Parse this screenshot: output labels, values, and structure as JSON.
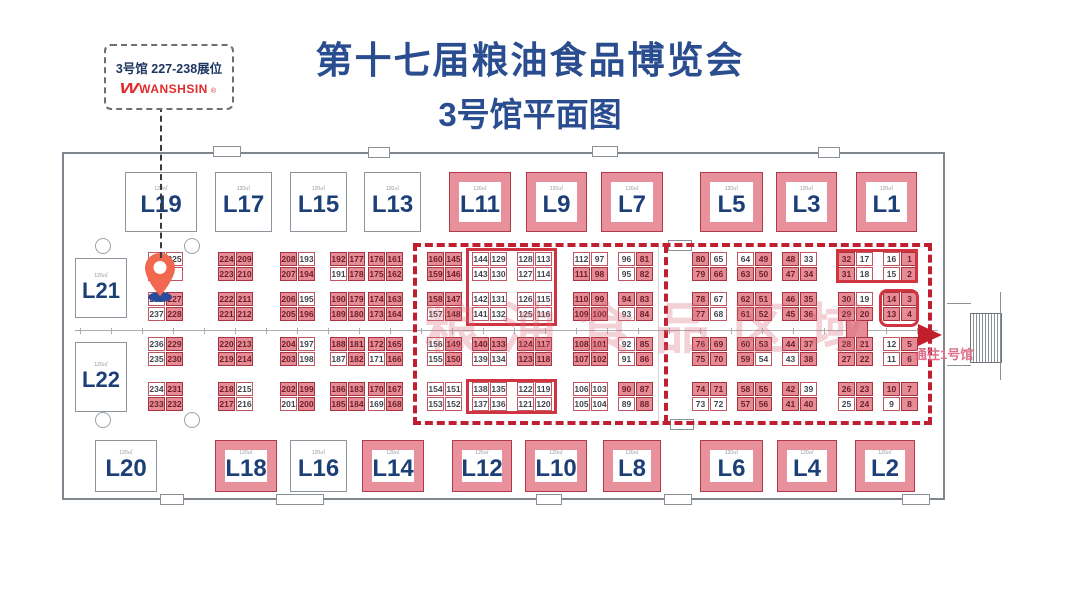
{
  "title": {
    "line1": "第十七届粮油食品博览会",
    "line2": "3号馆平面图"
  },
  "callout": {
    "booths_text": "3号馆 227-238展位",
    "logo_glyph": "W",
    "brand": "WANSHSIN",
    "reg_mark": "®"
  },
  "watermark": "粮油食品区域",
  "exit": {
    "label": "通往1号馆"
  },
  "area_label": "120㎡",
  "colors": {
    "title_blue": "#2a4d8f",
    "brand_red": "#e02c2c",
    "navy_label": "#1d3f77",
    "booth_pink": "#e8919c",
    "cell_pink": "#e58c97",
    "cell_border_red": "#a8323e",
    "dashed_red": "#bf1f2e",
    "pin_red": "#f2674f",
    "pin_blue": "#2a4b9b",
    "wall_gray": "#80868d",
    "watermark_pink": "#d96b7a"
  },
  "large_booths": {
    "top_y": 172,
    "top_h": 60,
    "bottom_y": 440,
    "bottom_h": 52,
    "top": [
      {
        "label": "L19",
        "x": 125,
        "w": 72,
        "pink": 0
      },
      {
        "label": "L17",
        "x": 215,
        "w": 57,
        "pink": 0
      },
      {
        "label": "L15",
        "x": 290,
        "w": 57,
        "pink": 0
      },
      {
        "label": "L13",
        "x": 364,
        "w": 57,
        "pink": 0
      },
      {
        "label": "L11",
        "x": 449,
        "w": 62,
        "pink": 1
      },
      {
        "label": "L9",
        "x": 526,
        "w": 61,
        "pink": 1
      },
      {
        "label": "L7",
        "x": 601,
        "w": 62,
        "pink": 1
      },
      {
        "label": "L5",
        "x": 700,
        "w": 63,
        "pink": 1
      },
      {
        "label": "L3",
        "x": 776,
        "w": 61,
        "pink": 1
      },
      {
        "label": "L1",
        "x": 856,
        "w": 61,
        "pink": 1
      }
    ],
    "bottom": [
      {
        "label": "L20",
        "x": 95,
        "w": 62,
        "pink": 0
      },
      {
        "label": "L18",
        "x": 215,
        "w": 62,
        "pink": 1
      },
      {
        "label": "L16",
        "x": 290,
        "w": 57,
        "pink": 0
      },
      {
        "label": "L14",
        "x": 362,
        "w": 62,
        "pink": 1
      },
      {
        "label": "L12",
        "x": 452,
        "w": 60,
        "pink": 1
      },
      {
        "label": "L10",
        "x": 525,
        "w": 62,
        "pink": 1
      },
      {
        "label": "L8",
        "x": 603,
        "w": 58,
        "pink": 1
      },
      {
        "label": "L6",
        "x": 700,
        "w": 63,
        "pink": 1
      },
      {
        "label": "L4",
        "x": 777,
        "w": 60,
        "pink": 1
      },
      {
        "label": "L2",
        "x": 855,
        "w": 60,
        "pink": 1
      }
    ],
    "left": [
      {
        "label": "L21",
        "x": 75,
        "y": 258,
        "w": 52,
        "h": 60,
        "pink": 0
      },
      {
        "label": "L22",
        "x": 75,
        "y": 342,
        "w": 52,
        "h": 70,
        "pink": 0
      }
    ]
  },
  "row_y": [
    252,
    267,
    292,
    307,
    337,
    352,
    382,
    397
  ],
  "booth_pairs": [
    {
      "x": 148,
      "rows": [
        [
          "240",
          0,
          "225",
          0
        ],
        [
          "",
          0,
          "",
          0
        ],
        [
          "238",
          0,
          "227",
          1
        ],
        [
          "237",
          0,
          "228",
          1
        ],
        [
          "236",
          0,
          "229",
          1
        ],
        [
          "235",
          0,
          "230",
          1
        ],
        [
          "234",
          0,
          "231",
          1
        ],
        [
          "233",
          1,
          "232",
          1
        ]
      ]
    },
    {
      "x": 218,
      "rows": [
        [
          "224",
          1,
          "209",
          1
        ],
        [
          "223",
          1,
          "210",
          1
        ],
        [
          "222",
          1,
          "211",
          1
        ],
        [
          "221",
          1,
          "212",
          1
        ],
        [
          "220",
          1,
          "213",
          1
        ],
        [
          "219",
          1,
          "214",
          1
        ],
        [
          "218",
          1,
          "215",
          0
        ],
        [
          "217",
          1,
          "216",
          0
        ]
      ]
    },
    {
      "x": 280,
      "rows": [
        [
          "208",
          1,
          "193",
          0
        ],
        [
          "207",
          1,
          "194",
          1
        ],
        [
          "206",
          1,
          "195",
          0
        ],
        [
          "205",
          1,
          "196",
          1
        ],
        [
          "204",
          1,
          "197",
          0
        ],
        [
          "203",
          1,
          "198",
          0
        ],
        [
          "202",
          1,
          "199",
          1
        ],
        [
          "201",
          0,
          "200",
          1
        ]
      ]
    },
    {
      "x": 330,
      "rows": [
        [
          "192",
          1,
          "177",
          1
        ],
        [
          "191",
          0,
          "178",
          1
        ],
        [
          "190",
          1,
          "179",
          1
        ],
        [
          "189",
          1,
          "180",
          1
        ],
        [
          "188",
          1,
          "181",
          1
        ],
        [
          "187",
          0,
          "182",
          1
        ],
        [
          "186",
          1,
          "183",
          1
        ],
        [
          "185",
          1,
          "184",
          1
        ]
      ]
    },
    {
      "x": 368,
      "rows": [
        [
          "176",
          1,
          "161",
          1
        ],
        [
          "175",
          1,
          "162",
          1
        ],
        [
          "174",
          1,
          "163",
          1
        ],
        [
          "173",
          1,
          "164",
          1
        ],
        [
          "172",
          1,
          "165",
          1
        ],
        [
          "171",
          0,
          "166",
          1
        ],
        [
          "170",
          1,
          "167",
          1
        ],
        [
          "169",
          0,
          "168",
          1
        ]
      ]
    },
    {
      "x": 427,
      "rows": [
        [
          "160",
          1,
          "145",
          1
        ],
        [
          "159",
          1,
          "146",
          1
        ],
        [
          "158",
          1,
          "147",
          1
        ],
        [
          "157",
          0,
          "148",
          1
        ],
        [
          "156",
          0,
          "149",
          1
        ],
        [
          "155",
          0,
          "150",
          1
        ],
        [
          "154",
          0,
          "151",
          0
        ],
        [
          "153",
          0,
          "152",
          0
        ]
      ]
    },
    {
      "x": 472,
      "rows": [
        [
          "144",
          0,
          "129",
          0
        ],
        [
          "143",
          0,
          "130",
          0
        ],
        [
          "142",
          0,
          "131",
          0
        ],
        [
          "141",
          0,
          "132",
          0
        ],
        [
          "140",
          1,
          "133",
          1
        ],
        [
          "139",
          0,
          "134",
          0
        ],
        [
          "138",
          0,
          "135",
          0
        ],
        [
          "137",
          0,
          "136",
          0
        ]
      ]
    },
    {
      "x": 517,
      "rows": [
        [
          "128",
          0,
          "113",
          0
        ],
        [
          "127",
          0,
          "114",
          0
        ],
        [
          "126",
          0,
          "115",
          0
        ],
        [
          "125",
          0,
          "116",
          0
        ],
        [
          "124",
          1,
          "117",
          1
        ],
        [
          "123",
          1,
          "118",
          1
        ],
        [
          "122",
          0,
          "119",
          0
        ],
        [
          "121",
          0,
          "120",
          0
        ]
      ]
    },
    {
      "x": 573,
      "rows": [
        [
          "112",
          0,
          "97",
          0
        ],
        [
          "111",
          1,
          "98",
          1
        ],
        [
          "110",
          1,
          "99",
          1
        ],
        [
          "109",
          1,
          "100",
          1
        ],
        [
          "108",
          1,
          "101",
          1
        ],
        [
          "107",
          1,
          "102",
          1
        ],
        [
          "106",
          0,
          "103",
          0
        ],
        [
          "105",
          0,
          "104",
          0
        ]
      ]
    },
    {
      "x": 618,
      "rows": [
        [
          "96",
          0,
          "81",
          1
        ],
        [
          "95",
          0,
          "82",
          1
        ],
        [
          "94",
          1,
          "83",
          1
        ],
        [
          "93",
          0,
          "84",
          1
        ],
        [
          "92",
          0,
          "85",
          1
        ],
        [
          "91",
          0,
          "86",
          1
        ],
        [
          "90",
          1,
          "87",
          1
        ],
        [
          "89",
          0,
          "88",
          1
        ]
      ]
    },
    {
      "x": 692,
      "rows": [
        [
          "80",
          1,
          "65",
          0
        ],
        [
          "79",
          1,
          "66",
          1
        ],
        [
          "78",
          1,
          "67",
          0
        ],
        [
          "77",
          1,
          "68",
          0
        ],
        [
          "76",
          1,
          "69",
          1
        ],
        [
          "75",
          1,
          "70",
          1
        ],
        [
          "74",
          1,
          "71",
          1
        ],
        [
          "73",
          0,
          "72",
          0
        ]
      ]
    },
    {
      "x": 737,
      "rows": [
        [
          "64",
          0,
          "49",
          1
        ],
        [
          "63",
          1,
          "50",
          1
        ],
        [
          "62",
          1,
          "51",
          1
        ],
        [
          "61",
          1,
          "52",
          1
        ],
        [
          "60",
          1,
          "53",
          1
        ],
        [
          "59",
          1,
          "54",
          0
        ],
        [
          "58",
          1,
          "55",
          1
        ],
        [
          "57",
          1,
          "56",
          1
        ]
      ]
    },
    {
      "x": 782,
      "rows": [
        [
          "48",
          1,
          "33",
          0
        ],
        [
          "47",
          1,
          "34",
          1
        ],
        [
          "46",
          1,
          "35",
          1
        ],
        [
          "45",
          1,
          "36",
          1
        ],
        [
          "44",
          1,
          "37",
          1
        ],
        [
          "43",
          0,
          "38",
          1
        ],
        [
          "42",
          1,
          "39",
          0
        ],
        [
          "41",
          1,
          "40",
          1
        ]
      ]
    },
    {
      "x": 838,
      "rows": [
        [
          "32",
          1,
          "17",
          0
        ],
        [
          "31",
          1,
          "18",
          0
        ],
        [
          "30",
          1,
          "19",
          0
        ],
        [
          "29",
          1,
          "20",
          1
        ],
        [
          "28",
          1,
          "21",
          1
        ],
        [
          "27",
          1,
          "22",
          1
        ],
        [
          "26",
          1,
          "23",
          1
        ],
        [
          "25",
          0,
          "24",
          1
        ]
      ]
    },
    {
      "x": 883,
      "rows": [
        [
          "16",
          0,
          "1",
          1
        ],
        [
          "15",
          0,
          "2",
          1
        ],
        [
          "14",
          1,
          "3",
          1
        ],
        [
          "13",
          1,
          "4",
          1
        ],
        [
          "12",
          0,
          "5",
          1
        ],
        [
          "11",
          0,
          "6",
          1
        ],
        [
          "10",
          1,
          "7",
          1
        ],
        [
          "9",
          0,
          "8",
          1
        ]
      ]
    }
  ]
}
